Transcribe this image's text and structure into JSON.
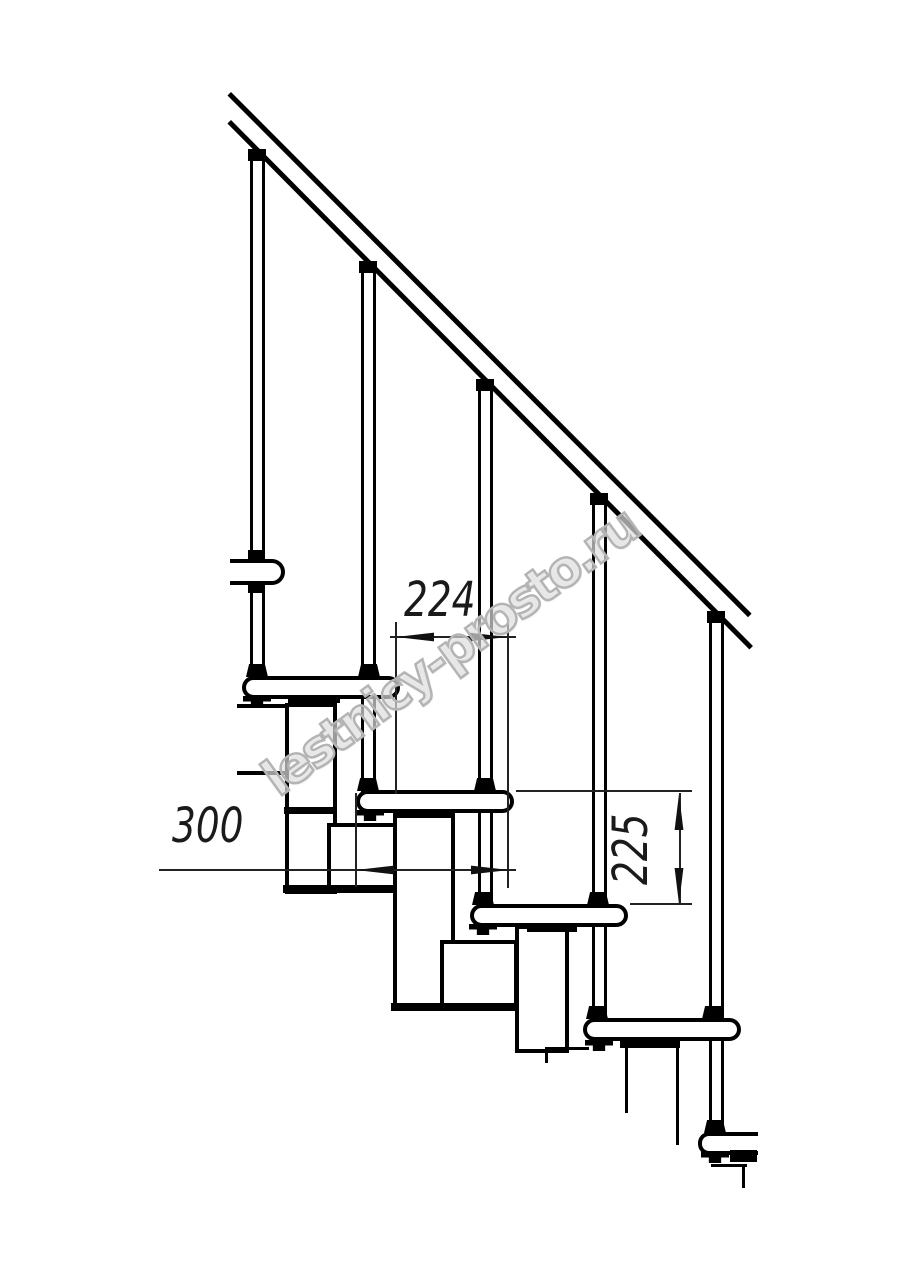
{
  "drawing": {
    "title": "Modular staircase side elevation",
    "labels": {
      "run": "224",
      "going": "300",
      "rise": "225"
    },
    "watermark": "lestnicy-prosto.ru",
    "colors": {
      "line": "#000000",
      "dimension": "#222222",
      "watermark": "#b4b4b4",
      "background": "#ffffff"
    }
  }
}
